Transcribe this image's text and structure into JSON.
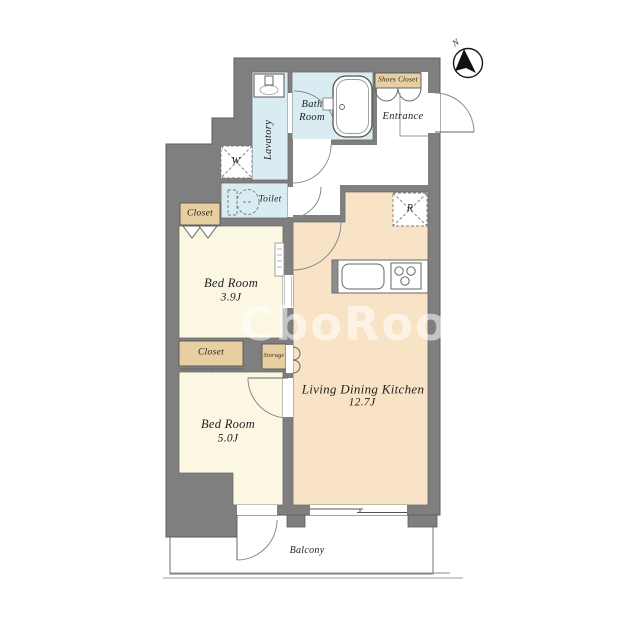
{
  "watermark": "CboRooM",
  "compass": {
    "north": "N"
  },
  "rooms": {
    "lavatory": "Lavatory",
    "bath_line1": "Bath",
    "bath_line2": "Room",
    "toilet": "Toilet",
    "entrance": "Entrance",
    "shoes_closet": "Shoes Closet",
    "closet_upper": "Closet",
    "closet_lower": "Closet",
    "storage": "Storage",
    "bedroom_upper_name": "Bed Room",
    "bedroom_upper_size": "3.9J",
    "bedroom_lower_name": "Bed Room",
    "bedroom_lower_size": "5.0J",
    "ldk_name": "Living Dining Kitchen",
    "ldk_size": "12.7J",
    "balcony": "Balcony"
  },
  "fixtures": {
    "washer": "W",
    "refrigerator": "R"
  },
  "colors": {
    "wall": "#7f7f7f",
    "wet_area": "#d9ecf2",
    "bedroom": "#fbf7e3",
    "ldk": "#f9e3c7",
    "closet": "#e7cfa1",
    "line": "#5d5d5d"
  }
}
